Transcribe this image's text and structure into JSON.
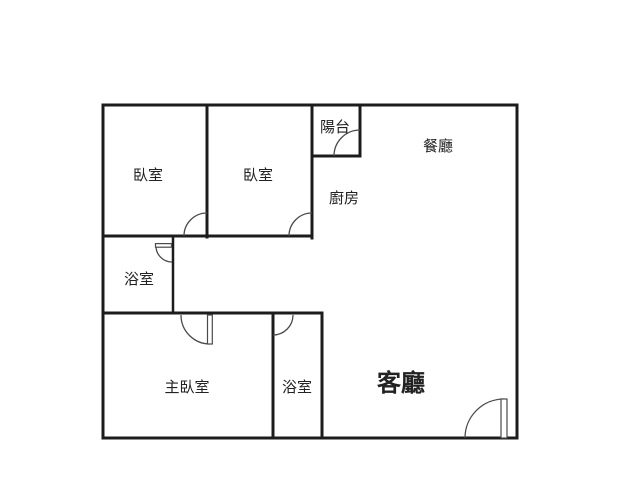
{
  "floorplan": {
    "background": "#ffffff",
    "wall_color": "#1c1c1c",
    "door_color": "#4a4a4a",
    "text_color": "#222222",
    "canvas": {
      "width": 640,
      "height": 480
    },
    "outer_boundary": {
      "x": 103,
      "y": 105,
      "w": 414,
      "h": 333,
      "stroke": 3
    },
    "inner_walls": [
      {
        "id": "bedroom-divider-wall",
        "x1": 207,
        "y1": 105,
        "x2": 207,
        "y2": 237,
        "t": 3
      },
      {
        "id": "bedroom2-right-wall",
        "x1": 312,
        "y1": 105,
        "x2": 312,
        "y2": 238,
        "t": 3
      },
      {
        "id": "balcony-right-wall",
        "x1": 360,
        "y1": 105,
        "x2": 360,
        "y2": 156,
        "t": 3
      },
      {
        "id": "balcony-bottom-wall",
        "x1": 312,
        "y1": 156,
        "x2": 360,
        "y2": 156,
        "t": 3
      },
      {
        "id": "bedrooms-bottom-wall",
        "x1": 103,
        "y1": 236,
        "x2": 312,
        "y2": 236,
        "t": 3
      },
      {
        "id": "bathroom1-right-wall",
        "x1": 173,
        "y1": 236,
        "x2": 173,
        "y2": 313,
        "t": 2.5
      },
      {
        "id": "hall-bottom-wall",
        "x1": 103,
        "y1": 313,
        "x2": 322,
        "y2": 313,
        "t": 3
      },
      {
        "id": "bathroom2-left-wall",
        "x1": 273,
        "y1": 313,
        "x2": 273,
        "y2": 438,
        "t": 3
      },
      {
        "id": "bathroom2-right-wall",
        "x1": 322,
        "y1": 313,
        "x2": 322,
        "y2": 438,
        "t": 3
      }
    ],
    "doors": [
      {
        "id": "bedroom1-door",
        "arc": "M 184 236 A 23 23 0 0 1 207 213"
      },
      {
        "id": "bedroom2-door",
        "arc": "M 289 236 A 23 23 0 0 1 312 213"
      },
      {
        "id": "balcony-door",
        "arc": "M 334 156 A 26 26 0 0 1 360 130"
      },
      {
        "id": "bathroom1-door",
        "arc": "M 156 246 A 16 16 0 0 0 172 262",
        "leaf": {
          "x": 155.5,
          "y": 243.6,
          "w": 16,
          "h": 3.6
        }
      },
      {
        "id": "master-bedroom-door",
        "arc": "M 181 315 A 29 29 0 0 0 210 344",
        "leaf": {
          "x": 207.5,
          "y": 315,
          "w": 4.8,
          "h": 29
        }
      },
      {
        "id": "bathroom2-door",
        "arc": "M 293 315 A 20 20 0 0 1 273 335"
      },
      {
        "id": "entry-door",
        "arc": "M 465 438 A 39 39 0 0 1 504 399",
        "leaf": {
          "x": 501,
          "y": 399,
          "w": 6,
          "h": 39
        }
      }
    ],
    "rooms": [
      {
        "id": "bedroom-1",
        "label": "臥室",
        "x": 148,
        "y": 175,
        "size": 15,
        "weight": 400
      },
      {
        "id": "bedroom-2",
        "label": "臥室",
        "x": 258,
        "y": 175,
        "size": 15,
        "weight": 400
      },
      {
        "id": "balcony",
        "label": "陽台",
        "x": 335,
        "y": 127,
        "size": 15,
        "weight": 400
      },
      {
        "id": "dining-room",
        "label": "餐廳",
        "x": 438,
        "y": 146,
        "size": 15,
        "weight": 400
      },
      {
        "id": "kitchen",
        "label": "廚房",
        "x": 344,
        "y": 198,
        "size": 15,
        "weight": 400
      },
      {
        "id": "bathroom-1",
        "label": "浴室",
        "x": 139,
        "y": 279,
        "size": 15,
        "weight": 400
      },
      {
        "id": "master-bedroom",
        "label": "主臥室",
        "x": 187,
        "y": 387,
        "size": 15,
        "weight": 400
      },
      {
        "id": "bathroom-2",
        "label": "浴室",
        "x": 297,
        "y": 387,
        "size": 15,
        "weight": 400
      },
      {
        "id": "living-room",
        "label": "客廳",
        "x": 401,
        "y": 383,
        "size": 24,
        "weight": 600
      }
    ]
  }
}
